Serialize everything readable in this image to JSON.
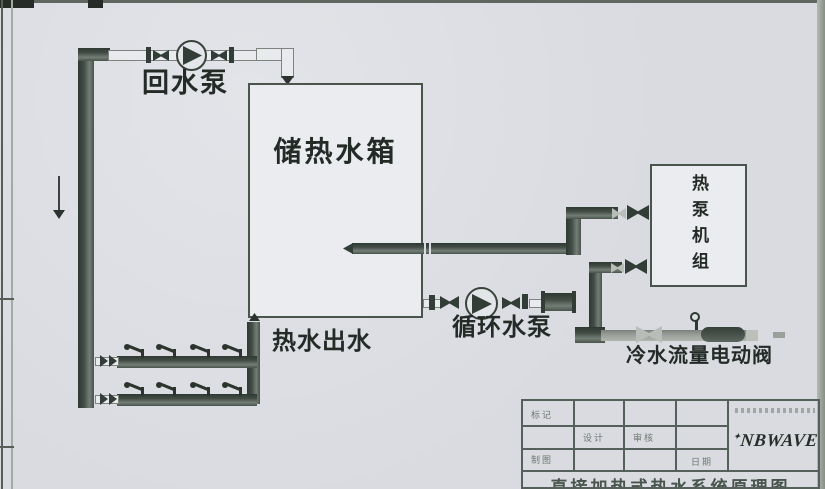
{
  "colors": {
    "background": "#d9dbe1",
    "pipe-dark": "#3f4a43",
    "pipe-light-fill": "#e8eaed",
    "pipe-light-border": "#7d847f",
    "pipe-gray": "#90958f",
    "box-fill": "#eaecf0",
    "box-border": "#49544d",
    "ink": "#242b26",
    "frame": "#60675f"
  },
  "labels": {
    "return_pump": "回水泵",
    "storage_tank": "储热水箱",
    "hot_water_outlet": "热水出水",
    "circulation_pump": "循环水泵",
    "cold_water_valve": "冷水流量电动阀",
    "heat_pump_unit": "热泵机组"
  },
  "title_block": {
    "row1_col1": "标记",
    "row2_col2": "设计",
    "row2_col3": "审核",
    "row3_col1": "制图",
    "row3_col4": "日期",
    "logo_mark": "✦",
    "logo_text": "NBWAVE",
    "drawing_title": "直接加热式热水系统原理图"
  }
}
